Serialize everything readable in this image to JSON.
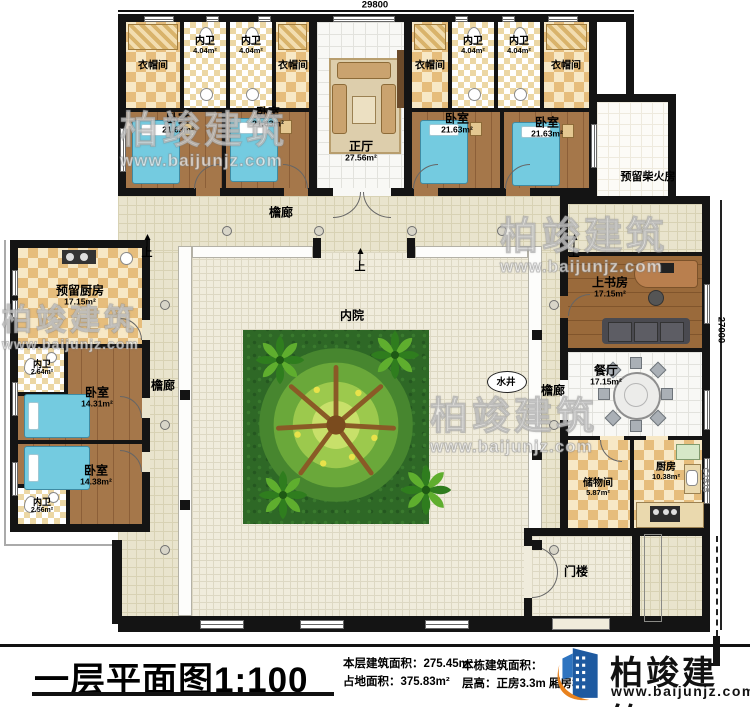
{
  "dimensions": {
    "top_width": "29800",
    "right_height": "27000",
    "window_code": "C1515"
  },
  "markers": {
    "step_up": "上"
  },
  "watermark": {
    "brand": "柏竣建筑",
    "url": "www.baijunjz.com"
  },
  "rooms": {
    "cloakroom_1": {
      "label": "衣帽间"
    },
    "cloakroom_2": {
      "label": "衣帽间"
    },
    "cloakroom_3": {
      "label": "衣帽间"
    },
    "cloakroom_4": {
      "label": "衣帽间"
    },
    "bath_top_1": {
      "label": "内卫",
      "area": "4.04m²"
    },
    "bath_top_2": {
      "label": "内卫",
      "area": "4.04m²"
    },
    "bath_top_3": {
      "label": "内卫",
      "area": "4.04m²"
    },
    "bath_top_4": {
      "label": "内卫",
      "area": "4.04m²"
    },
    "bedroom_1": {
      "label": "卧室",
      "area": "21.63m²"
    },
    "bedroom_2": {
      "label": "卧室",
      "area": "21.63m²"
    },
    "bedroom_3": {
      "label": "卧室",
      "area": "21.63m²"
    },
    "bedroom_4": {
      "label": "卧室",
      "area": "21.63m²"
    },
    "main_hall": {
      "label": "正厅",
      "area": "27.56m²"
    },
    "firewood_reserved": {
      "label": "预留柴火房"
    },
    "veranda_top": {
      "label": "檐廊"
    },
    "veranda_left": {
      "label": "檐廊"
    },
    "veranda_right": {
      "label": "檐廊"
    },
    "courtyard": {
      "label": "内院"
    },
    "well": {
      "label": "水井"
    },
    "kitchen_reserved": {
      "label": "预留厨房",
      "area": "17.15m²"
    },
    "bath_left_1": {
      "label": "内卫",
      "area": "2.64m²"
    },
    "bedroom_left_1": {
      "label": "卧室",
      "area": "14.31m²"
    },
    "bedroom_left_2": {
      "label": "卧室",
      "area": "14.38m²"
    },
    "bath_left_2": {
      "label": "内卫",
      "area": "2.56m²"
    },
    "study": {
      "label": "上书房",
      "area": "17.15m²"
    },
    "dining": {
      "label": "餐厅",
      "area": "17.15m²"
    },
    "storage": {
      "label": "储物间",
      "area": "5.87m²"
    },
    "kitchen": {
      "label": "厨房",
      "area": "10.38m²"
    },
    "gatehouse": {
      "label": "门楼"
    }
  },
  "titleblock": {
    "title": "一层平面图1:100",
    "floor_area_label": "本层建筑面积：",
    "floor_area_value": "275.45m²",
    "land_area_label": "占地面积：",
    "land_area_value": "375.83m²",
    "building_area_label": "本栋建筑面积：",
    "storey_height_label": "层高：",
    "storey_height_value": "正房3.3m 厢房3.0m",
    "logo_brand": "柏竣建筑",
    "logo_url": "www.baijunjz.com"
  }
}
